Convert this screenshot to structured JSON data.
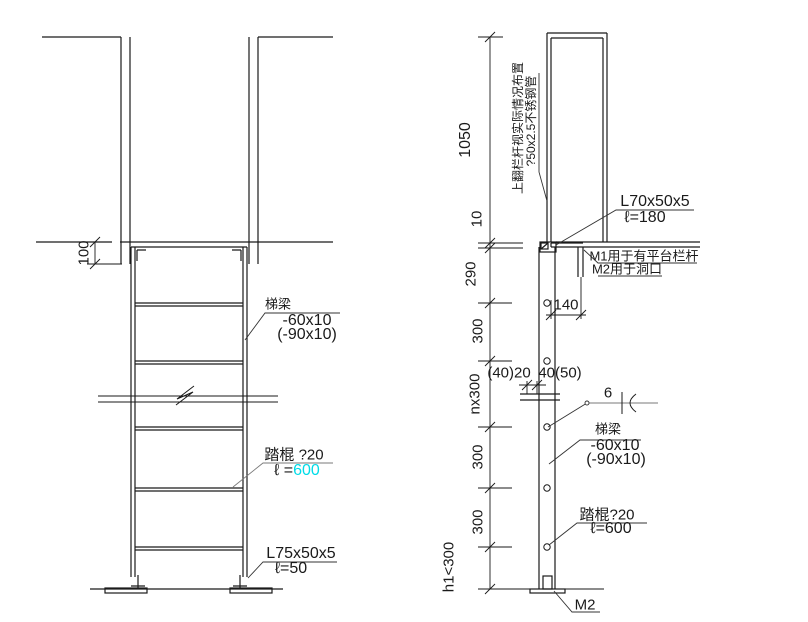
{
  "left_view": {
    "dim_100": "100",
    "beam_name": "梯梁",
    "beam_size": "-60x10",
    "beam_size_alt": "(-90x10)",
    "rung_name": "踏棍 ?20",
    "rung_len_prefix": "ℓ =",
    "rung_len_value": "600",
    "base_angle_size": "L75x50x5",
    "base_angle_len": "ℓ=50"
  },
  "right_view": {
    "dims": [
      "1050",
      "10",
      "290",
      "300",
      "nx300",
      "300",
      "300",
      "h1<300"
    ],
    "rail_note_line1": "上翻栏杆视实际情况布置",
    "rail_note_line2": "?50x2.5不锈钢管",
    "top_angle_size": "L70x50x5",
    "top_angle_len": "ℓ=180",
    "bolt_note_m1": "M1用于有平台栏杆",
    "bolt_note_m2": "M2用于洞口",
    "dim_140": "140",
    "dim_splice_left": "(40)20",
    "dim_splice_right": "40(50)",
    "weld_size": "6",
    "beam_name": "梯梁",
    "beam_size": "-60x10",
    "beam_size_alt": "(-90x10)",
    "rung_label": "踏棍?20",
    "rung_len": "ℓ=600",
    "base_mark": "M2"
  },
  "colors": {
    "line": "#1a1a1a",
    "leader_gray": "#7a7a7a",
    "highlight_cyan": "#00dce8"
  }
}
